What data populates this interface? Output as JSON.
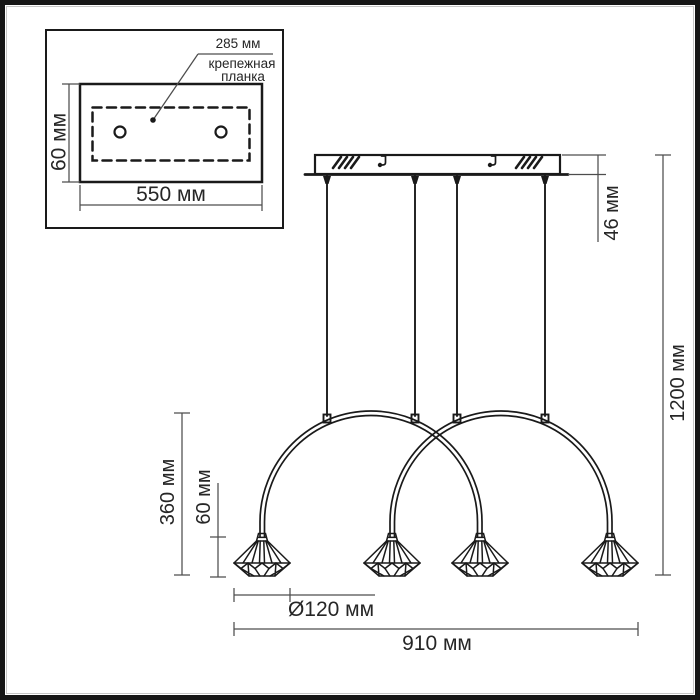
{
  "colors": {
    "bg": "#ffffff",
    "line": "#1a1a1a",
    "dim": "#4d4d4d",
    "text": "#262626"
  },
  "unit": "мм",
  "inset_panel": {
    "description": "mounting-plate-top-view",
    "plate_length": {
      "label": "285 мм",
      "value_mm": 285
    },
    "plate_caption": {
      "line1": "крепежная",
      "line2": "планка"
    },
    "plate_height": {
      "label": "60 мм",
      "value_mm": 60
    },
    "plate_width": {
      "label": "550 мм",
      "value_mm": 550
    },
    "hole_count": 2
  },
  "main_drawing": {
    "description": "pendant-luminaire-front-view",
    "canopy_height": {
      "label": "46 мм",
      "value_mm": 46
    },
    "overall_height": {
      "label": "1200 мм",
      "value_mm": 1200
    },
    "arm_drop_height": {
      "label": "360 мм",
      "value_mm": 360
    },
    "shade_height": {
      "label": "60 мм",
      "value_mm": 60
    },
    "shade_diameter": {
      "label": "Ø120 мм",
      "value_mm": 120
    },
    "overall_width": {
      "label": "910 мм",
      "value_mm": 910
    },
    "shade_count": 4,
    "suspension_wire_count": 4,
    "arch_count": 2
  }
}
